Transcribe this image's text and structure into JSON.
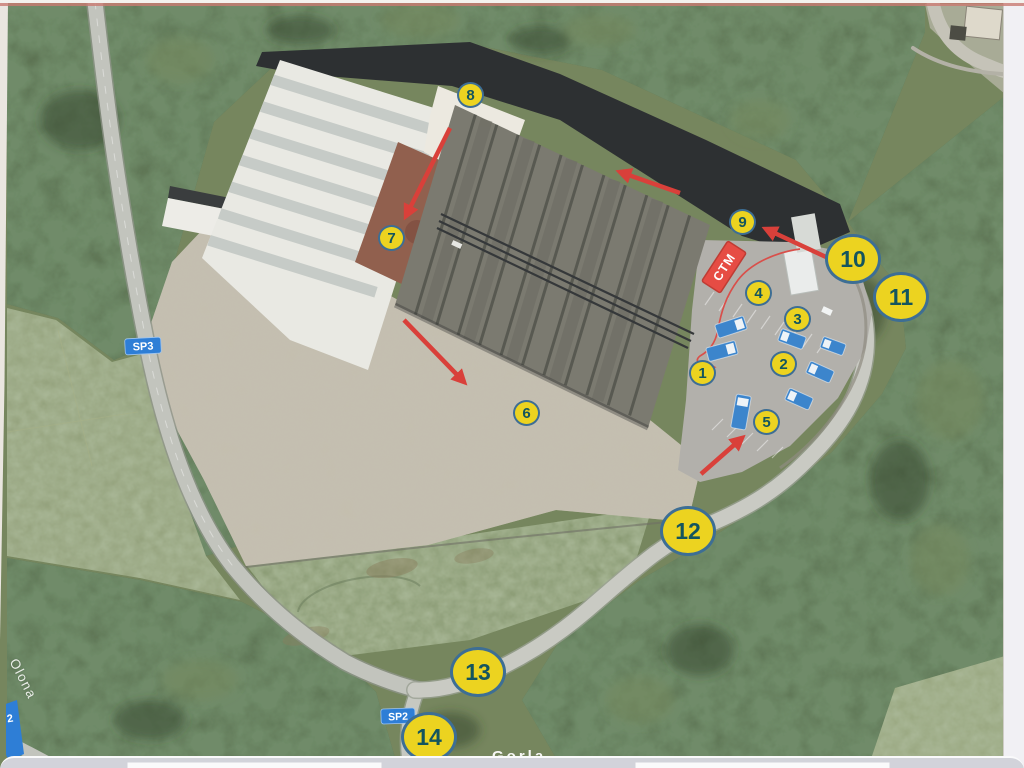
{
  "annotations": {
    "site_label": "CTM",
    "markers": {
      "m1": "1",
      "m2": "2",
      "m3": "3",
      "m4": "4",
      "m5": "5",
      "m6": "6",
      "m7": "7",
      "m8": "8",
      "m9": "9",
      "m10": "10",
      "m11": "11",
      "m12": "12",
      "m13": "13",
      "m14": "14"
    },
    "road_badges": {
      "sp3": "SP3",
      "sp2": "SP2",
      "sp2_edge": "2"
    },
    "water_label": "Olona",
    "place_label_partial": "Gorla",
    "vehicle_markers_count": 7,
    "red_arrows_count": 5,
    "colors": {
      "marker_fill": "#ecd320",
      "marker_border": "#3d6e94",
      "marker_text": "#14555e",
      "arrow_red": "#d9403a",
      "route_line_red": "#d94f4a",
      "vehicle_blue": "#3c85cc",
      "site_label_bg": "#e64c44",
      "road_badge_blue": "#2e7ed6"
    }
  }
}
